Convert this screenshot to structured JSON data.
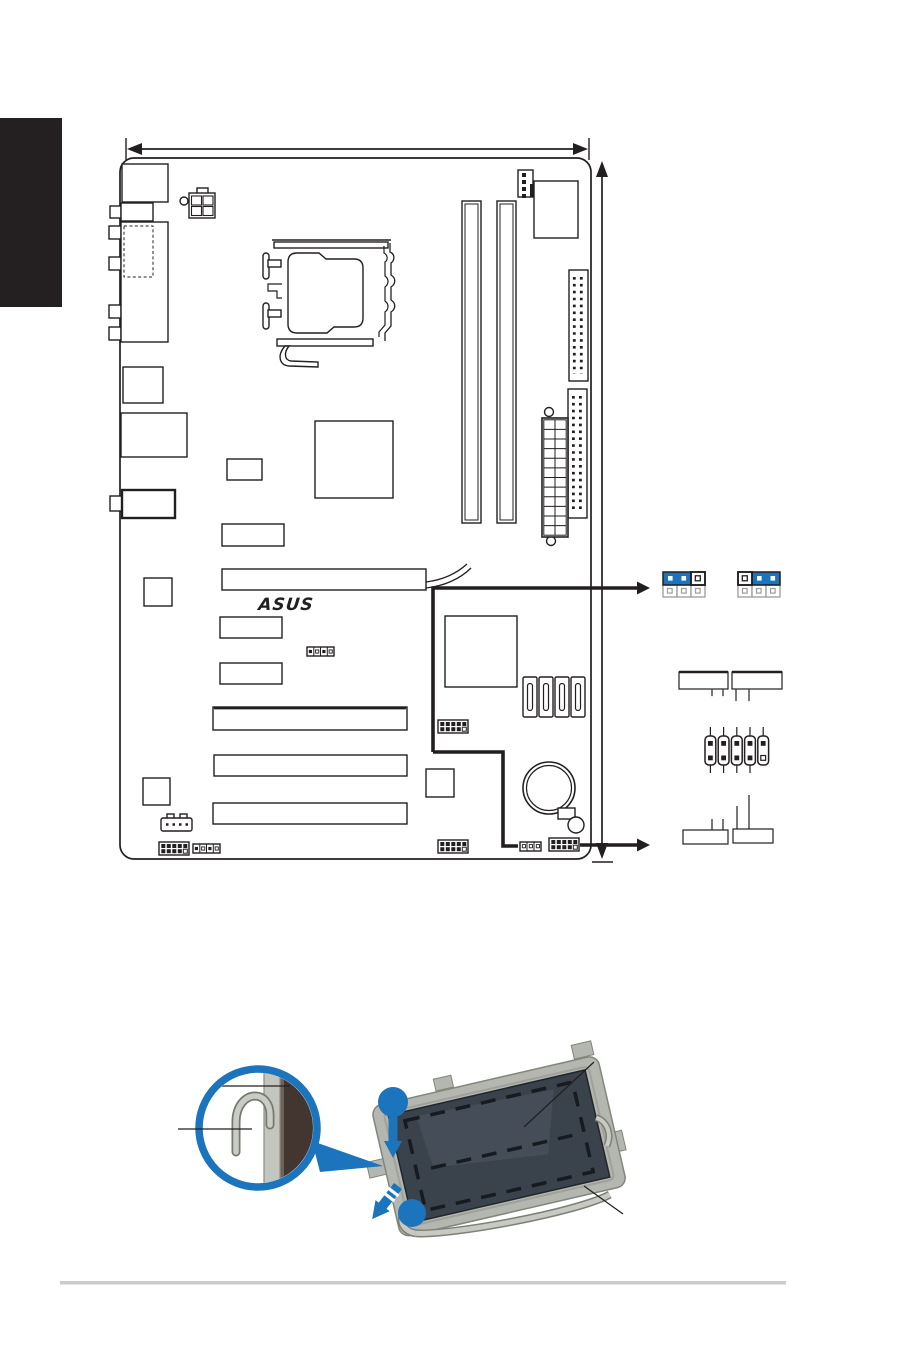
{
  "page": {
    "kind": "motherboard-manual-page",
    "background_color": "#ffffff",
    "section_tab_color": "#242021",
    "footer_divider_color": "#cbcbcb"
  },
  "colors": {
    "line_art": "#231f20",
    "accent_blue": "#1b74bc",
    "muted_pin_gray": "#9c9c9c",
    "photo_metal": "#b4b7af",
    "photo_cover": "#3a424c"
  },
  "board_figure": {
    "logo_text": "ASUS",
    "dimm_slots": 2,
    "pci_slots": 3,
    "pcie_x1_slots": 2,
    "sata_ports": 4,
    "jumper_settings": [
      {
        "side": "left",
        "cap_on_pins": "1-2",
        "open_pin": "3"
      },
      {
        "side": "right",
        "cap_on_pins": "2-3",
        "open_pin": "1"
      }
    ],
    "pin_header_diagram": {
      "columns": 5,
      "rows": 2,
      "missing_pin": "bottom-right"
    },
    "empty_label_boxes": 4
  },
  "cpu_figure": {
    "step_markers": 2,
    "inset": "load-lever-detail",
    "callout_lines": 4
  }
}
